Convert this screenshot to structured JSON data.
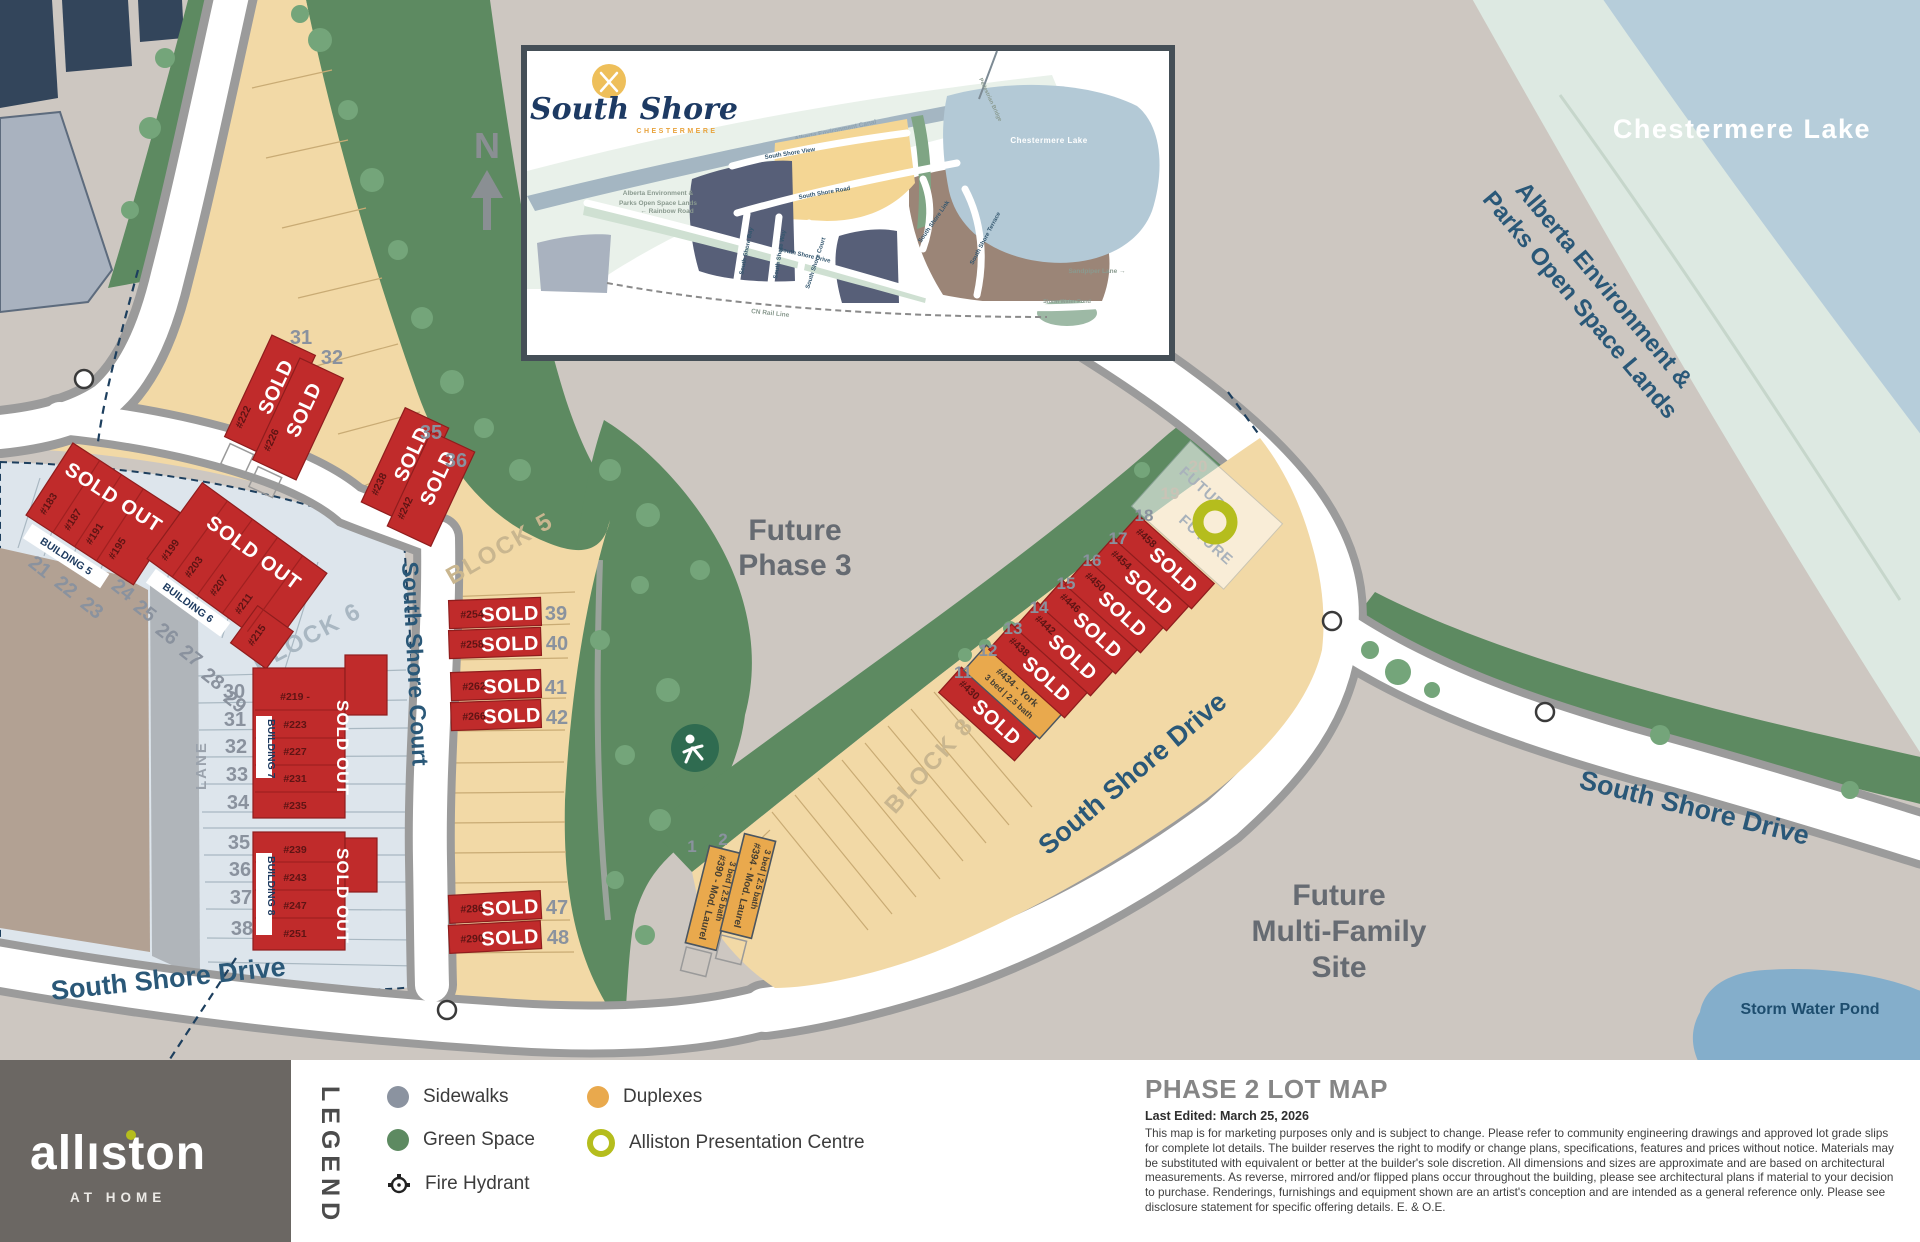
{
  "colors": {
    "sold_red": "#c02b2b",
    "duplex_orange": "#e9a94d",
    "lime_accent": "#b5bd1d",
    "sidewalk_gray": "#8b93a0",
    "green_space": "#5d8a61",
    "tan_lot": "#f2d9a6",
    "lake_blue": "#b6cdda",
    "brand_box": "#6b6763"
  },
  "compass": {
    "n": "N"
  },
  "inset": {
    "logo_name": "South Shore",
    "logo_sub": "CHESTERMERE",
    "labels": {
      "canal": "Alberta Environment Canal",
      "pedestrian": "Pedestrian Bridge",
      "view": "South Shore View",
      "road": "South Shore Road",
      "link": "South Shore Link",
      "terrace": "South Shore Terrace",
      "lake": "Chestermere Lake",
      "sandpiper": "Sandpiper Lane →",
      "drive": "South Shore Drive",
      "bay": "South Shore Bay",
      "way": "South Shore Way",
      "court": "South Shore Court",
      "rail": "CN Rail Line",
      "rainbow": "← Rainbow Road",
      "open1": "Alberta Environment &",
      "open2": "Parks Open Space Lands",
      "pond": "Storm Water Pond"
    }
  },
  "map": {
    "lake": "Chestermere Lake",
    "open1": "Alberta Environment &",
    "open2": "Parks Open Space Lands",
    "future1": "Future",
    "future2": "Phase 3",
    "mf1": "Future",
    "mf2": "Multi-Family",
    "mf3": "Site",
    "pond": "Storm Water Pond",
    "drive": "South Shore Drive",
    "court": "South Shore Court",
    "lane": "LANE",
    "block5": "BLOCK 5",
    "block6": "BLOCK 6",
    "block8": "BLOCK 8",
    "future_lot": "FUTURE"
  },
  "labels": {
    "sold": "SOLD",
    "sold_out": "SOLD OUT"
  },
  "lots": {
    "chips": [
      "BUILDING 5",
      "BUILDING 6",
      "BUILDING 7",
      "BUILDING 8"
    ],
    "b5_units": [
      "#183",
      "#187",
      "#191",
      "#195"
    ],
    "b6_units": [
      "#199",
      "#203",
      "#207",
      "#211",
      "#215"
    ],
    "b7_units": [
      "#219 -",
      "#223",
      "#227",
      "#231",
      "#235"
    ],
    "b8_units": [
      "#239",
      "#243",
      "#247",
      "#251"
    ],
    "left_nums": [
      "21",
      "22",
      "23",
      "24",
      "25",
      "26",
      "27",
      "28",
      "29",
      "30",
      "31",
      "32",
      "33",
      "34",
      "35",
      "36",
      "37",
      "38"
    ],
    "band_nums": [
      "31",
      "32",
      "35",
      "36",
      "39",
      "40",
      "41",
      "42",
      "47",
      "48"
    ],
    "pair_units": [
      "#222",
      "#226",
      "#238",
      "#242"
    ],
    "row_units": [
      "#254",
      "#258",
      "#262",
      "#266",
      "#286",
      "#290"
    ],
    "diag_nums": [
      "1",
      "2",
      "11",
      "12",
      "13",
      "14",
      "15",
      "16",
      "17",
      "18",
      "19",
      "20"
    ],
    "diag_units": [
      "#430",
      "#438",
      "#442",
      "#446",
      "#450",
      "#454",
      "#458"
    ],
    "york1": "#434 - York",
    "york2": "3 bed | 2.5 bath",
    "laurel1a": "#390 - Mod. Laurel",
    "laurel1b": "3 bed | 2.5 bath",
    "laurel2a": "#394 - Mod. Laurel",
    "laurel2b": "3 bed | 2.5 bath"
  },
  "legend": {
    "title": "LEGEND",
    "items": [
      "Sidewalks",
      "Green Space",
      "Fire Hydrant",
      "Duplexes",
      "Alliston Presentation Centre"
    ]
  },
  "footer": {
    "brand_a": "all",
    "brand_i": "ı",
    "brand_b": "ston",
    "tagline": "AT HOME"
  },
  "info": {
    "heading": "PHASE 2 LOT MAP",
    "edited": "Last Edited: March 25, 2026",
    "disclaimer": "This map is for marketing purposes only and is subject to change. Please refer to community engineering drawings and approved lot grade slips for complete lot details. The builder reserves the right to modify or change plans, specifications, features and prices without notice. Materials may be substituted with equivalent or better at the builder's sole discretion. All dimensions and sizes are approximate and are based on architectural measurements. As reverse, mirrored and/or flipped plans occur throughout the building, please see architectural plans if material to your decision to purchase. Renderings, furnishings and equipment shown are an artist's conception and are intended as a general reference only. Please see disclosure statement for specific offering details. E. & O.E."
  }
}
